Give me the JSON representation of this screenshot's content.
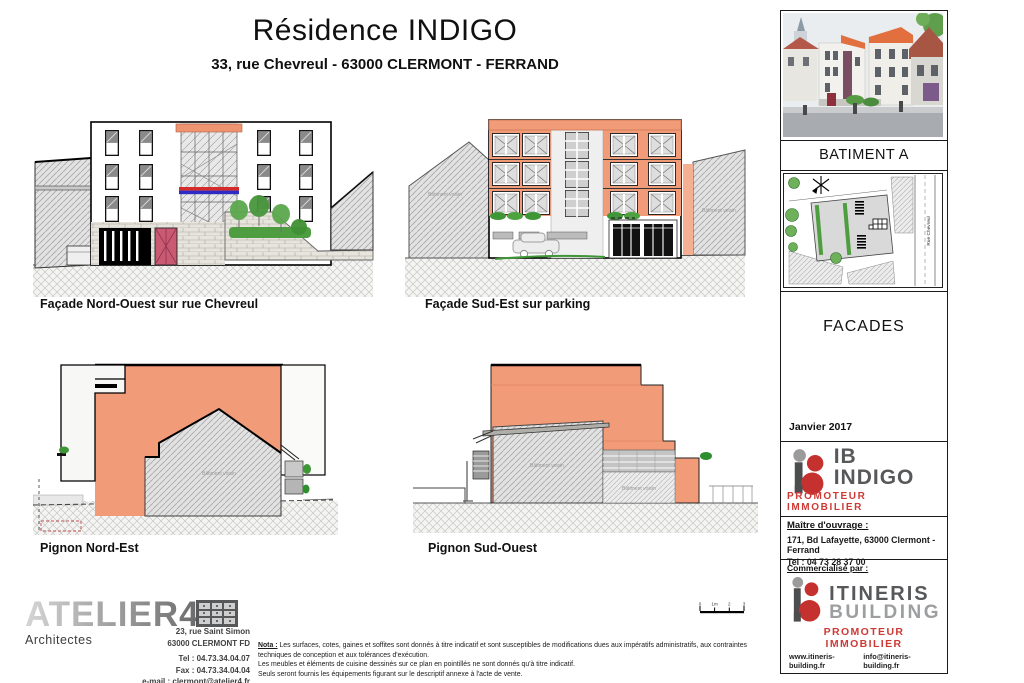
{
  "header": {
    "title": "Résidence INDIGO",
    "subtitle": "33, rue Chevreul  -  63000 CLERMONT - FERRAND"
  },
  "drawings": {
    "facade_nw_label": "Façade Nord-Ouest sur rue Chevreul",
    "facade_se_label": "Façade Sud-Est sur parking",
    "pignon_ne_label": "Pignon Nord-Est",
    "pignon_so_label": "Pignon Sud-Ouest",
    "neighbor_annotation": "Bâtiment voisin"
  },
  "scalebar": {
    "labels": [
      "0",
      "1m",
      "2",
      "3"
    ]
  },
  "panel": {
    "batiment": "BATIMENT A",
    "siteplan_street": "Rue Chevreul",
    "doc_title": "FACADES",
    "date": "Janvier 2017",
    "owner": {
      "name": "IB INDIGO",
      "tagline": "PROMOTEUR IMMOBILIER",
      "label": "Maître d'ouvrage  :",
      "address": "171, Bd Lafayette, 63000 Clermont - Ferrand",
      "tel": "Tel : 04 73 28 37 00"
    },
    "marketer": {
      "label": "Commercialisé par :",
      "name_top": "ITINERIS",
      "name_bottom": "BUILDING",
      "tagline": "PROMOTEUR IMMOBILIER",
      "website": "www.itineris-building.fr",
      "email": "info@itineris-building.fr"
    }
  },
  "architect": {
    "name": "ATELIER4",
    "subtitle": "Architectes",
    "address1": "23, rue Saint Simon",
    "address2": "63000 CLERMONT FD",
    "tel": "Tel : 04.73.34.04.07",
    "fax": "Fax : 04.73.34.04.04",
    "email": "e-mail : clermont@atelier4.fr"
  },
  "nota": {
    "label": "Nota :",
    "line1": "Les surfaces, cotes, gaines et soffites sont donnés à titre indicatif et sont susceptibles de modifications dues aux impératifs administratifs, aux contraintes techniques de conception et aux tolérances d'exécution.",
    "line2": "Les meubles et éléments de cuisine dessinés sur ce plan en pointillés ne sont donnés qu'à titre indicatif.",
    "line3": "Seuls seront fournis les équipements figurant sur le descriptif annexe à l'acte de vente."
  },
  "colors": {
    "salmon": "#F29B79",
    "cornice_edge": "#C4714F",
    "band_red": "#D42B2B",
    "band_blue": "#2C2CC4",
    "door_pink": "#C95A72",
    "green": "#4E9E41",
    "logo_red": "#CD3A36",
    "logo_gray": "#57585A"
  }
}
